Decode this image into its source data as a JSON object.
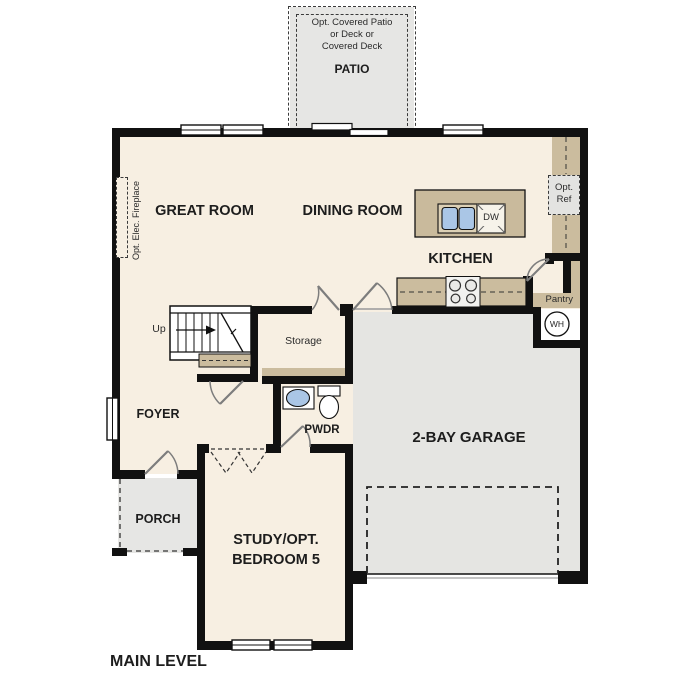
{
  "plan_title": "MAIN LEVEL",
  "patio": {
    "note_lines": [
      "Opt. Covered Patio",
      "or Deck or",
      "Covered Deck"
    ],
    "label": "PATIO"
  },
  "rooms": {
    "great_room": {
      "label": "GREAT ROOM"
    },
    "dining_room": {
      "label": "DINING ROOM"
    },
    "kitchen": {
      "label": "KITCHEN"
    },
    "storage": {
      "label": "Storage"
    },
    "foyer": {
      "label": "FOYER"
    },
    "powder": {
      "label": "PWDR"
    },
    "garage": {
      "label": "2-BAY GARAGE"
    },
    "porch": {
      "label": "PORCH"
    },
    "study": {
      "label": "STUDY/OPT. BEDROOM 5"
    },
    "pantry": {
      "label": "Pantry"
    }
  },
  "features": {
    "stairs_direction": "Up",
    "opt_ref": "Opt. Ref",
    "water_heater": "WH",
    "dishwasher": "DW",
    "fireplace": "Opt. Elec. Fireplace"
  },
  "colors": {
    "wall": "#111111",
    "interior_cream": "#f7efe2",
    "exterior_gray": "#e6e6e3",
    "counter_tan": "#cbbc9e",
    "fixture_blue": "#aac6e6"
  }
}
